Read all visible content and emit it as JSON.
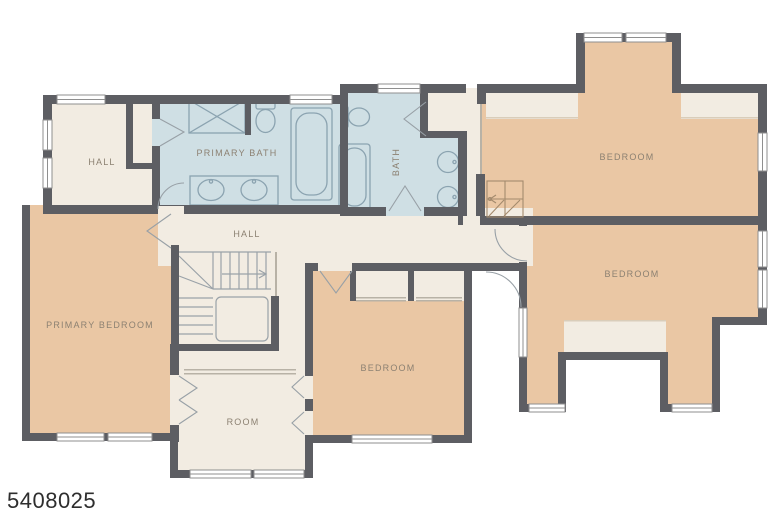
{
  "floorplan": {
    "listing_id": "5408025",
    "rooms": {
      "hall_upper": {
        "label": "HALL"
      },
      "primary_bath": {
        "label": "PRIMARY BATH"
      },
      "bath": {
        "label": "BATH"
      },
      "bedroom_top_right": {
        "label": "BEDROOM"
      },
      "bedroom_right": {
        "label": "BEDROOM"
      },
      "hall_center": {
        "label": "HALL"
      },
      "primary_bedroom": {
        "label": "PRIMARY BEDROOM"
      },
      "bedroom_center": {
        "label": "BEDROOM"
      },
      "flex_room": {
        "label": "ROOM"
      }
    },
    "colors": {
      "background": "#ffffff",
      "wall": "#5d5e63",
      "bedroom_fill": "#eac7a4",
      "hall_fill": "#f2ece2",
      "bath_fill": "#cfdfe4",
      "fixture_line": "#8ba3b0",
      "door_line": "#98a0a6",
      "stair_line": "#9aa2a8",
      "attic_stair_line": "#a38a6d",
      "label_text": "#8c8172",
      "listing_id_text": "#2e2e2e"
    },
    "icons": [
      "bathtub-icon",
      "toilet-icon",
      "sink-icon",
      "double-vanity-icon",
      "linen-closet-icon",
      "staircase-icon",
      "attic-stair-icon",
      "door-swing-icon",
      "window-icon"
    ]
  }
}
